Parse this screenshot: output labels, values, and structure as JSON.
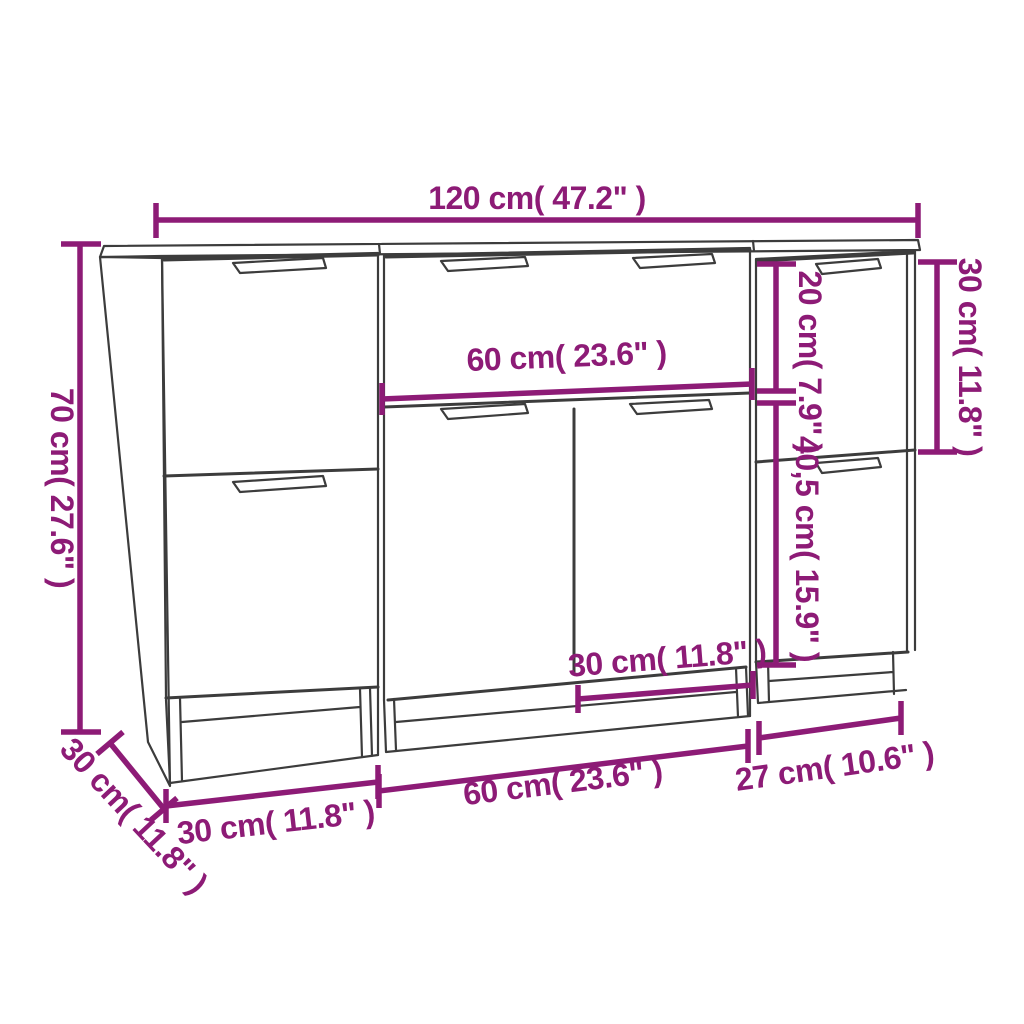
{
  "diagram": {
    "title": "sideboard-3-piece-dimension-drawing",
    "colors": {
      "dimension_accent": "#8d1b76",
      "drawing_outline": "#3c3c3c",
      "background": "#ffffff"
    },
    "labels": {
      "overall_width": "120 cm( 47.2\" )",
      "overall_height": "70 cm( 27.6\" )",
      "depth": "30 cm( 11.8\" )",
      "left_unit_width": "30 cm( 11.8\" )",
      "middle_unit_width": "60 cm( 23.6\" )",
      "right_unit_width": "27 cm( 10.6\" )",
      "middle_drawer_width": "60 cm( 23.6\" )",
      "middle_right_door_width": "30 cm( 11.8\" )",
      "right_drawer_height": "20 cm( 7.9\" )",
      "right_top_section_height": "30 cm( 11.8\" )",
      "right_door_height": "40,5 cm( 15.9\" )"
    }
  }
}
